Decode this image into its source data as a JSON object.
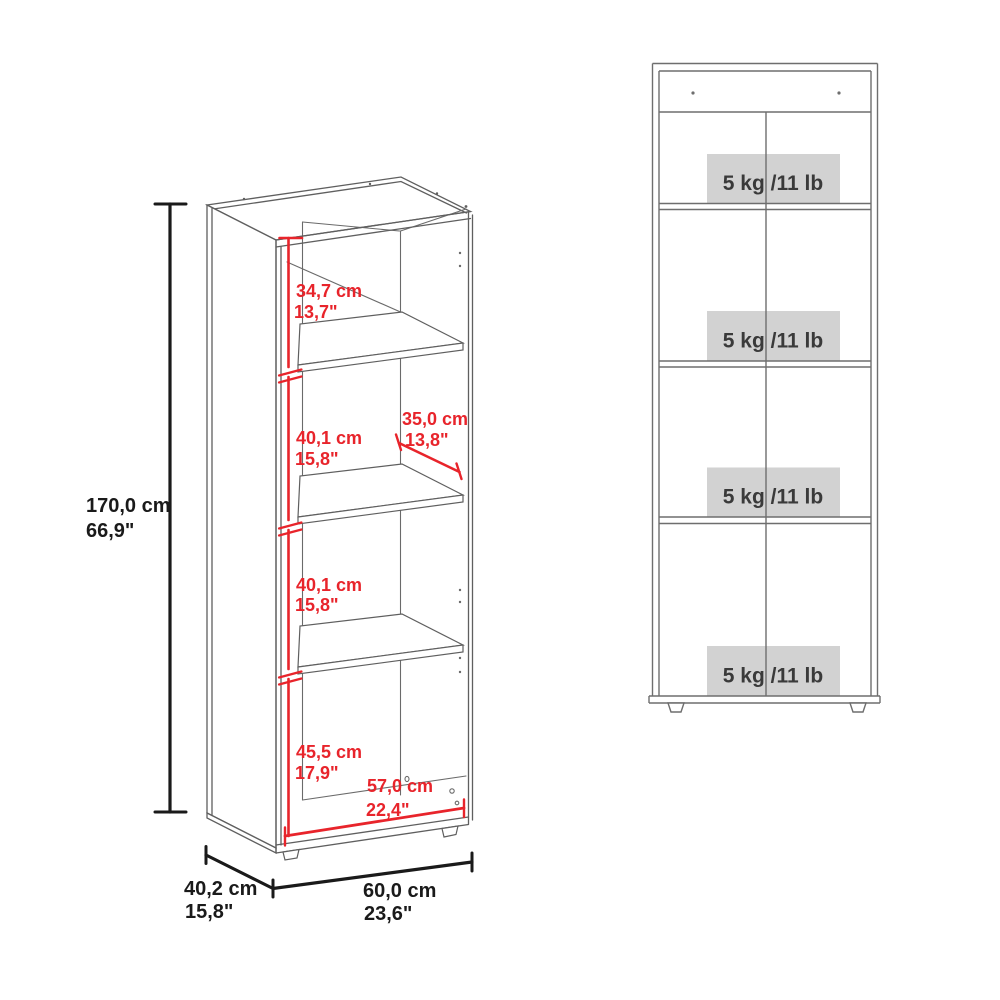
{
  "iso_view": {
    "overall_height": {
      "cm": "170,0 cm",
      "in": "66,9\""
    },
    "overall_depth": {
      "cm": "40,2 cm",
      "in": "15,8\""
    },
    "overall_width": {
      "cm": "60,0 cm",
      "in": "23,6\""
    },
    "compartments": [
      {
        "cm": "34,7 cm",
        "in": "13,7\""
      },
      {
        "cm": "40,1 cm",
        "in": "15,8\""
      },
      {
        "cm": "40,1 cm",
        "in": "15,8\""
      },
      {
        "cm": "45,5 cm",
        "in": "17,9\""
      }
    ],
    "shelf_depth": {
      "cm": "35,0 cm",
      "in": "13,8\""
    },
    "inner_width": {
      "cm": "57,0 cm",
      "in": "22,4\""
    }
  },
  "front_view": {
    "capacity_labels": [
      "5 kg /11 lb",
      "5 kg /11 lb",
      "5 kg /11 lb",
      "5 kg /11 lb"
    ]
  },
  "colors": {
    "dimension_red": "#e8242b",
    "dimension_black": "#1a1a1a",
    "drawing_line_gray": "#5f5f5f",
    "front_view_line_gray": "#6e6e6e",
    "capacity_box_bg": "#d2d2d2",
    "capacity_text": "#3a3a3a"
  }
}
